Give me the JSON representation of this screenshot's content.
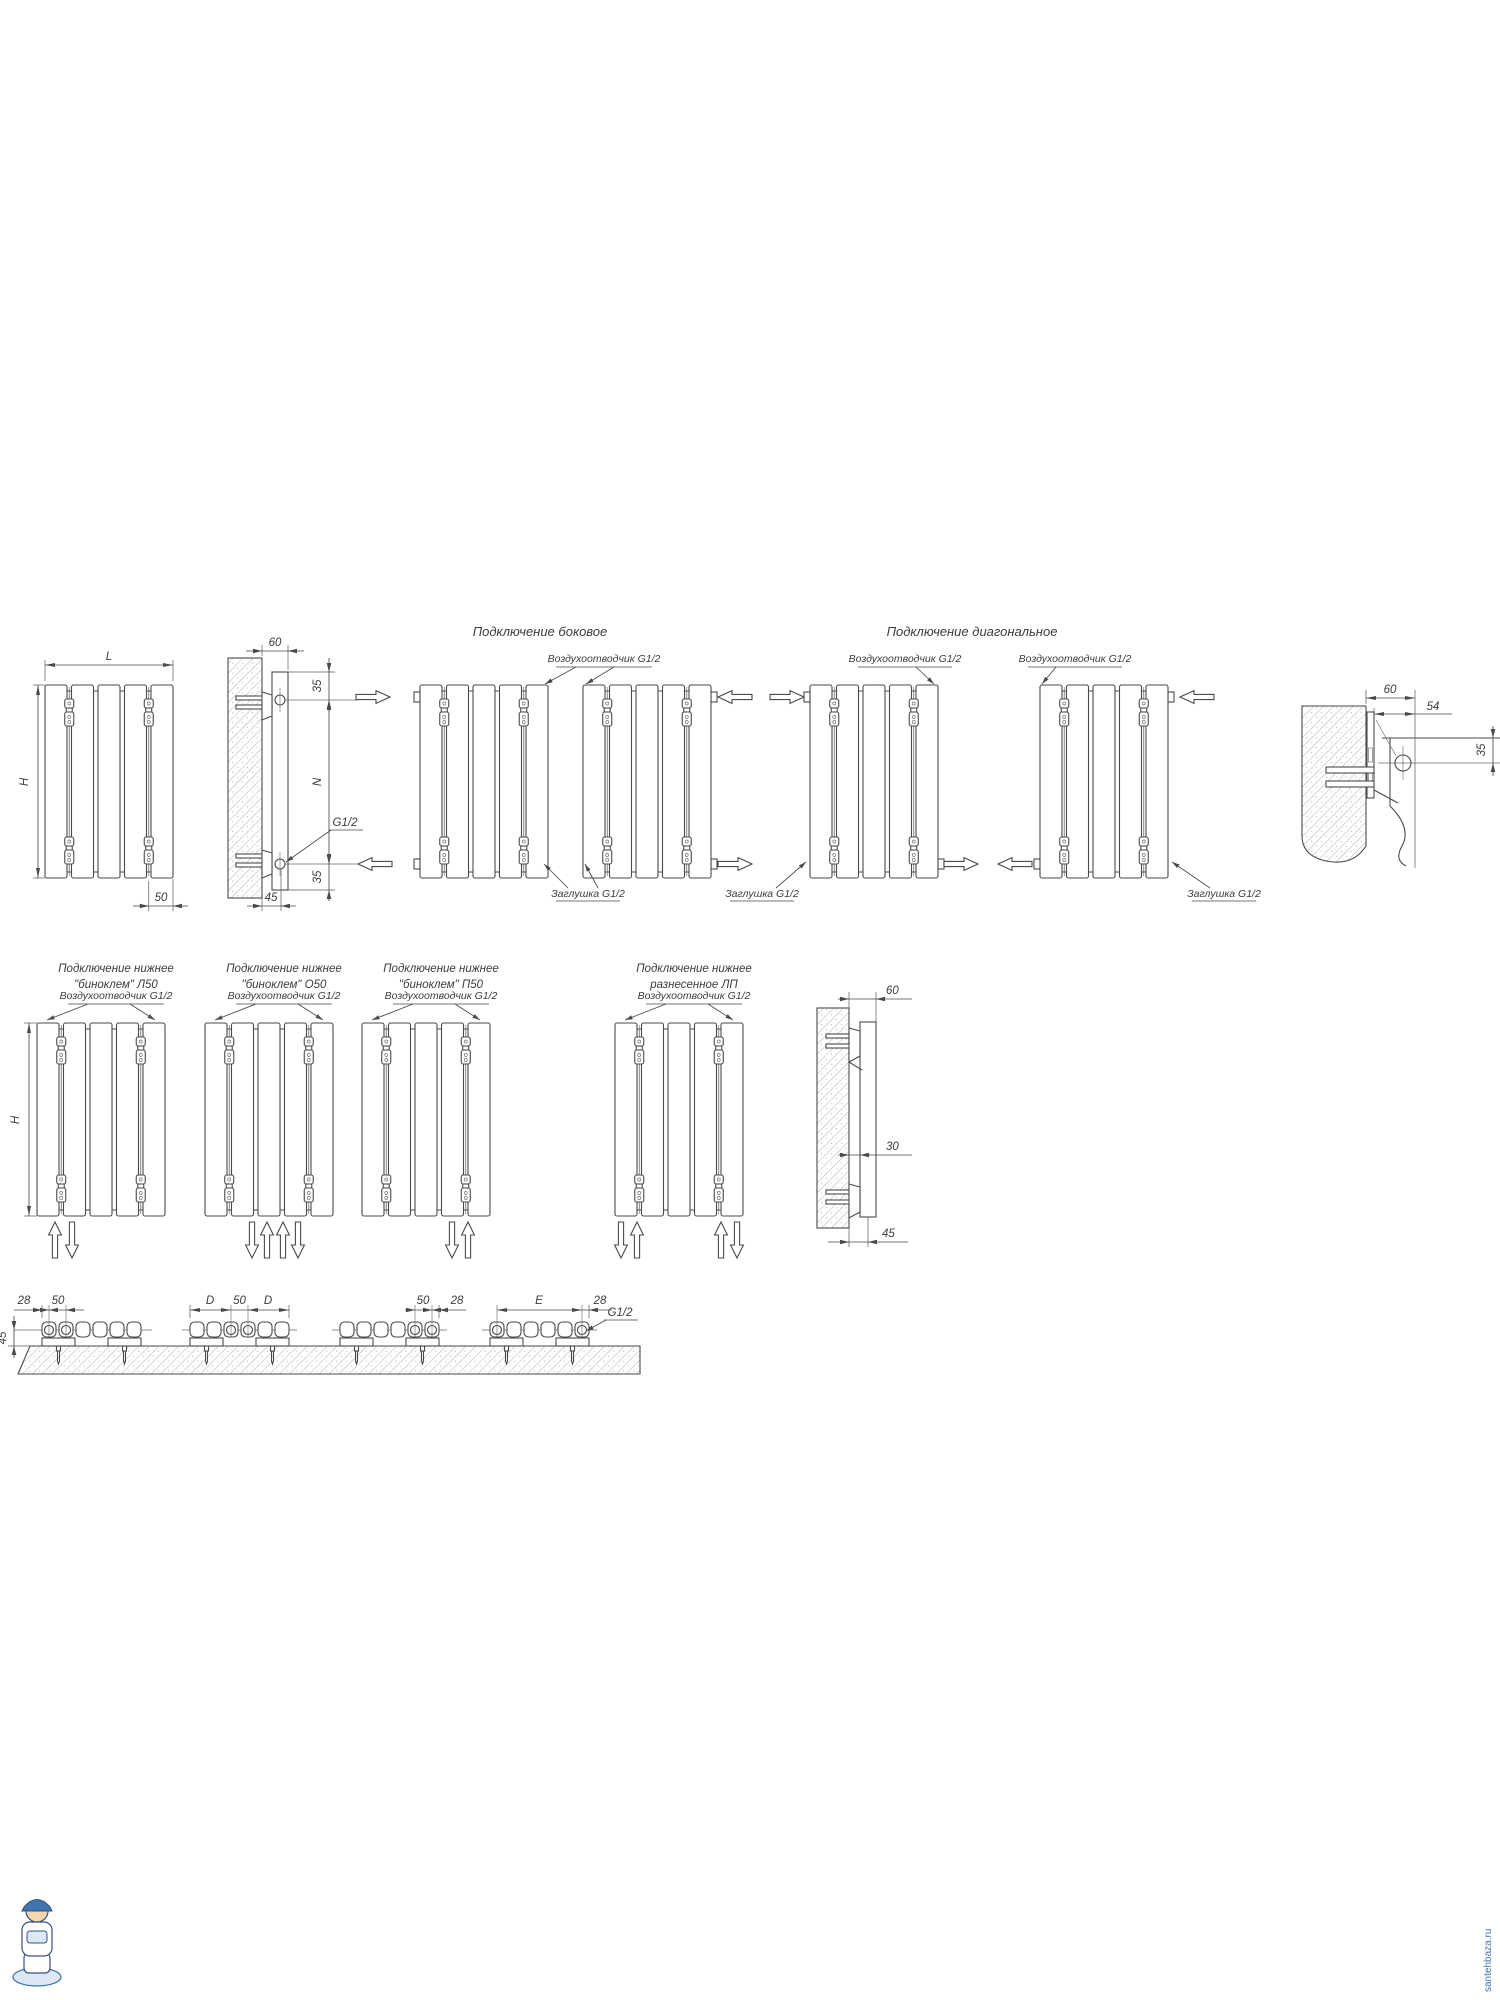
{
  "page": {
    "background": "#ffffff",
    "line_color": "#4a4a4a",
    "watermark_color": "#3f74ad"
  },
  "titles": {
    "side_connection": "Подключение боковое",
    "diagonal_connection": "Подключение диагональное",
    "bottom_row": [
      {
        "line1": "Подключение нижнее",
        "line2": "\"биноклем\" Л50"
      },
      {
        "line1": "Подключение нижнее",
        "line2": "\"биноклем\" О50"
      },
      {
        "line1": "Подключение нижнее",
        "line2": "\"биноклем\" П50"
      },
      {
        "line1": "Подключение нижнее",
        "line2": "разнесенное ЛП"
      }
    ]
  },
  "callouts": {
    "air_vent": "Воздухоотводчик G1/2",
    "plug": "Заглушка G1/2",
    "thread": "G1/2"
  },
  "dimensions": {
    "L": "L",
    "H": "H",
    "N": "N",
    "D": "D",
    "E": "E",
    "d60": "60",
    "d54": "54",
    "d50": "50",
    "d45": "45",
    "d35": "35",
    "d30": "30",
    "d28": "28"
  },
  "watermark": {
    "site": "santehbaza.ru"
  }
}
